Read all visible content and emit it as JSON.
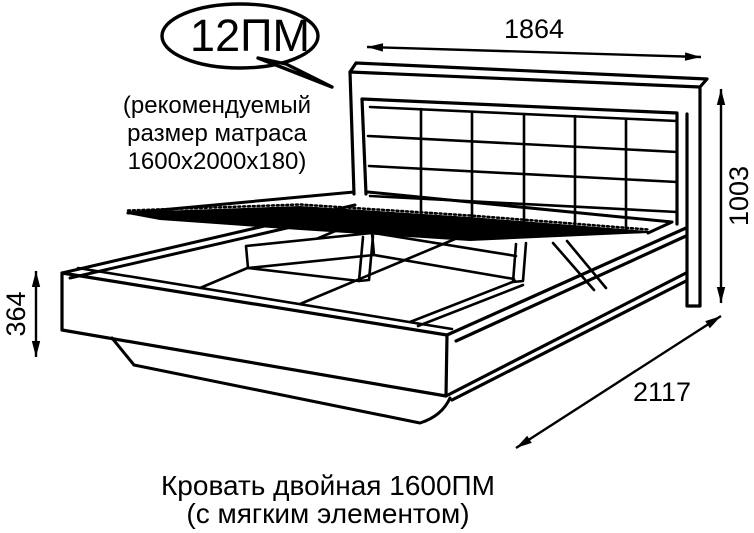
{
  "figure": {
    "callout": {
      "label": "12ПМ"
    },
    "note": {
      "line1": "(рекомендуемый",
      "line2": "размер матраса",
      "line3": "1600х2000х180)"
    },
    "dimensions": {
      "width_mm": "1864",
      "height_mm": "1003",
      "base_height_mm": "364",
      "length_mm": "2117"
    },
    "caption": {
      "line1": "Кровать двойная 1600ПМ",
      "line2": "(с мягким элементом)"
    },
    "colors": {
      "line": "#000000",
      "background": "#ffffff"
    }
  }
}
